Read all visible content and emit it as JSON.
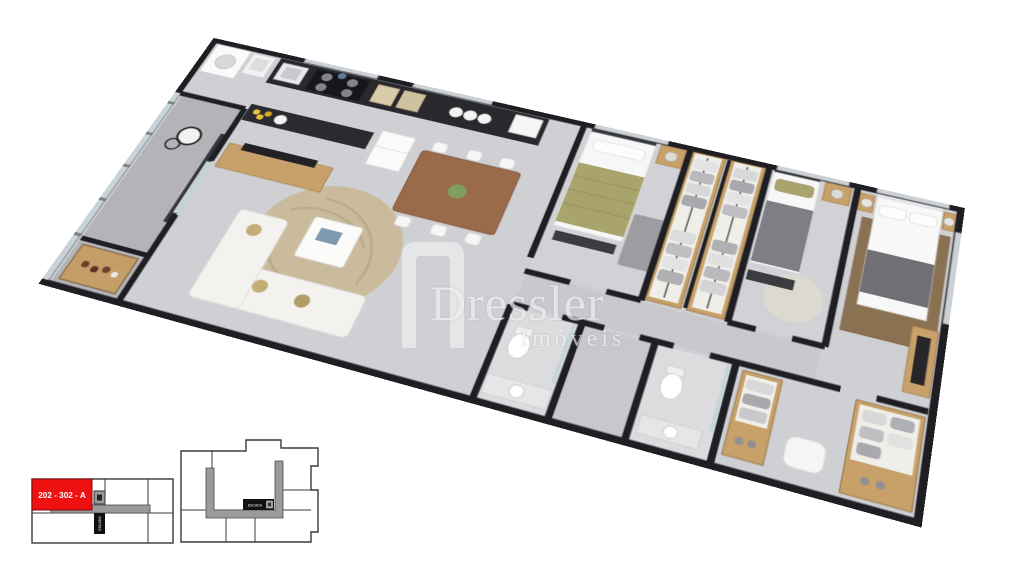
{
  "watermark": {
    "brand": "Dressler",
    "tagline": "Imóveis"
  },
  "keyplan": {
    "unit_label": "202 - 302 - A",
    "stairs_label": "ESCADA",
    "highlight_color": "#ee1111",
    "corridor_color": "#9a9a9a",
    "outline_color": "#3a3a3a",
    "stairs_box_color": "#111111"
  },
  "render_palette": {
    "wall": "#1e1e23",
    "floor": "#cfd0d4",
    "balcony_floor": "#b3b3b8",
    "wood": "#c7a169",
    "counter": "#28282d",
    "rug_beige": "#c9bb9b",
    "rug_brown": "#8a7152",
    "olive": "#a9a36e"
  }
}
